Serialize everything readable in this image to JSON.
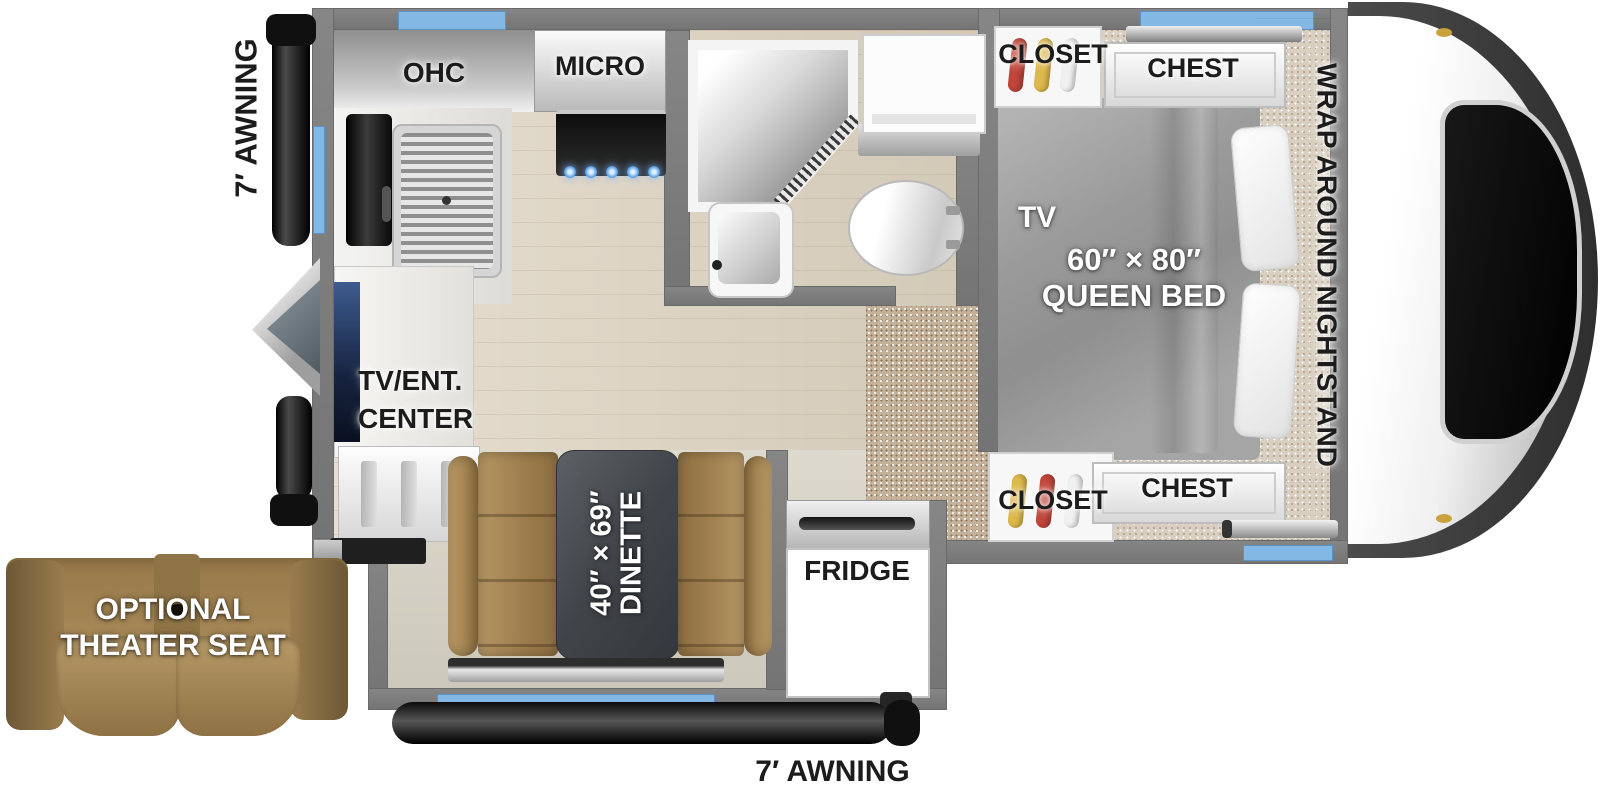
{
  "title": "Truck camper floorplan",
  "colors": {
    "wall": "#7d7d7d",
    "window_accent": "#84b8e4",
    "wood_floor": "#ded3c0",
    "carpet": "#c3b19a",
    "leather": "#a18350",
    "table": "#44484d",
    "bed_fabric": "#9b9b9b",
    "label_dark": "#1c1c1c",
    "label_light": "#ffffff",
    "burner_glow": "#63a7e8"
  },
  "exterior": {
    "awning_left_label": "7′ AWNING",
    "awning_bottom_label": "7′ AWNING",
    "theater_seat": {
      "line1": "OPTIONAL",
      "line2": "THEATER SEAT"
    }
  },
  "kitchen": {
    "ohc_label": "OHC",
    "micro_label": "MICRO",
    "tv_ent_line1": "TV/ENT.",
    "tv_ent_line2": "CENTER"
  },
  "dinette": {
    "dim_label": "40″ × 69″",
    "name_label": "DINETTE"
  },
  "fridge_label": "FRIDGE",
  "bedroom": {
    "closet_top_label": "CLOSET",
    "chest_top_label": "CHEST",
    "tv_label": "TV",
    "bed_dim_label": "60″ × 80″",
    "bed_name_label": "QUEEN BED",
    "nightstand_label": "WRAP AROUND NIGHTSTAND",
    "closet_bottom_label": "CLOSET",
    "chest_bottom_label": "CHEST"
  }
}
